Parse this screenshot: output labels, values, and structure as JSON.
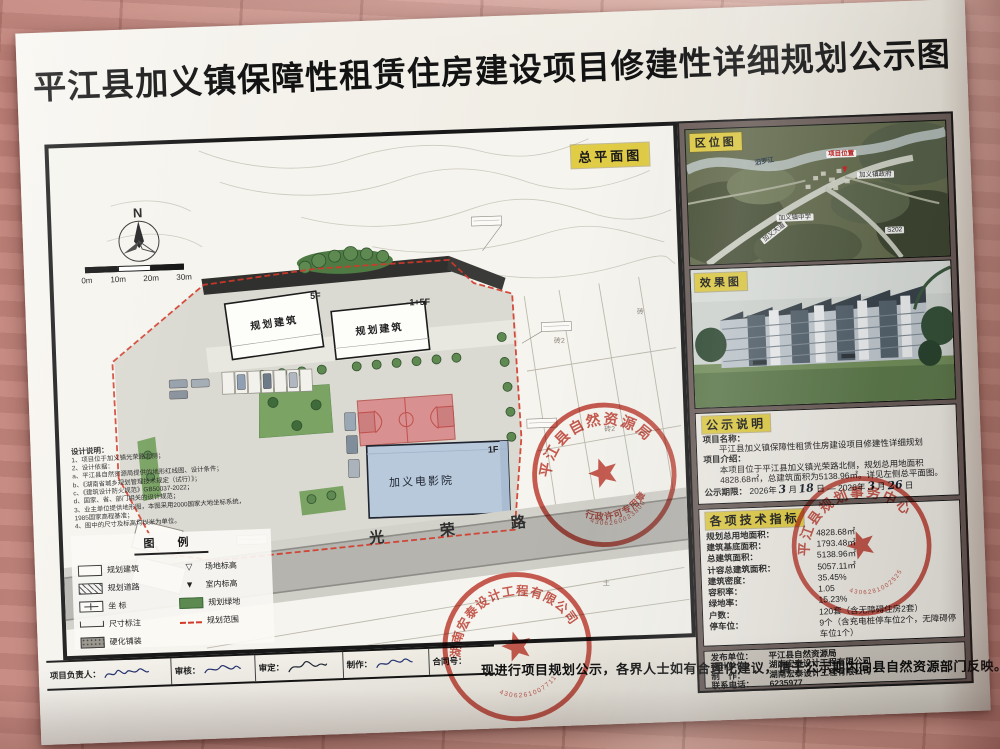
{
  "title": "平江县加义镇保障性租赁住房建设项目修建性详细规划公示图",
  "site_plan": {
    "label": "总平面图",
    "north_label": "N",
    "scale_labels": [
      "0m",
      "10m",
      "20m",
      "30m"
    ],
    "building_left": {
      "name": "规划建筑",
      "floors": "5F"
    },
    "building_right": {
      "name": "规划建筑",
      "floors": "-1+5F"
    },
    "cinema": {
      "name": "加义电影院",
      "floors": "1F"
    },
    "road_name": "光 荣 路",
    "design_notes": {
      "title": "设计说明：",
      "lines": [
        "1、项目位于加义镇光荣路北侧；",
        "2、设计依据：",
        "a、平江县自然资源局提供的地形红线图、设计条件；",
        "b、《湖南省城乡规划管理技术规定（试行）》；",
        "c、《建筑设计防火规范》GB50037-2022；",
        "d、国家、省、部门相关的设计规范；",
        "3、业主单位提供地形图，本图采用2000国家大地坐标系统，1985国家高程基准；",
        "4、图中的尺寸及标高均以米为单位。"
      ]
    },
    "legend": {
      "title": "图 例",
      "left": [
        "规划建筑",
        "规划道路",
        "坐 标",
        "尺寸标注",
        "硬化铺装"
      ],
      "right": [
        "场地标高",
        "室内标高",
        "规划绿地",
        "规划范围"
      ]
    },
    "parcel_labels": [
      "砖2",
      "砖2",
      "砖",
      "土"
    ]
  },
  "location_map": {
    "label": "区位图",
    "project_marker": "项目位置",
    "river": "汨罗江",
    "town_hall": "加义镇政府",
    "school": "加义镇中学",
    "avenue": "加义大道",
    "highway": "S202"
  },
  "rendering": {
    "label": "效果图"
  },
  "notice": {
    "label": "公示说明",
    "name_label": "项目名称：",
    "name": "平江县加义镇保障性租赁住房建设项目修建性详细规划",
    "intro_label": "项目介绍：",
    "intro": "本项目位于平江县加义镇光荣路北侧，规划总用地面积4828.68㎡，总建筑面积为5138.96㎡。详见左侧总平面图。",
    "period_label": "公示期限：",
    "period_parts": [
      "2026年",
      "3",
      "月",
      "18",
      "日 — 2026年",
      "3",
      "月",
      "26",
      "日"
    ]
  },
  "indicators": {
    "label": "各项技术指标",
    "rows": [
      {
        "k": "规划总用地面积：",
        "v": "4828.68㎡"
      },
      {
        "k": "建筑基底面积：",
        "v": "1793.48㎡"
      },
      {
        "k": "总建筑面积：",
        "v": "5138.96㎡"
      },
      {
        "k": "计容总建筑面积：",
        "v": "5057.11㎡"
      },
      {
        "k": "建筑密度：",
        "v": "35.45%"
      },
      {
        "k": "容积率：",
        "v": "1.05"
      },
      {
        "k": "绿地率：",
        "v": "15.23%"
      },
      {
        "k": "户数：",
        "v": "120套（含无障碍住房2套）"
      },
      {
        "k": "停车位：",
        "v": "9个（含充电桩停车位2个，无障碍停车位1个）"
      }
    ]
  },
  "publisher": {
    "rows": [
      {
        "k": "发布单位：",
        "v": "平江县自然资源局"
      },
      {
        "k": "设计单位：",
        "v": "湖南宏泰设计工程有限公司"
      },
      {
        "k": "制　作：",
        "v": "湖南宏泰设计工程有限公司"
      },
      {
        "k": "联系电话：",
        "v": "6235977"
      }
    ]
  },
  "footer": {
    "notice_text": "现进行项目规划公示，各界人士如有合理化建议，请于公示期内向县自然资源部门反映。",
    "fields": [
      "项目负责人：",
      "审核：",
      "审定：",
      "制作：",
      "合同号："
    ]
  },
  "stamps": {
    "bureau": {
      "arc": "平江县自然资源局",
      "sub": "行政许可专用章",
      "serial": "4306260023800"
    },
    "design": {
      "arc": "湖南宏泰设计工程有限公司",
      "serial": "4306261007711"
    },
    "center": {
      "arc": "平江县规划事务中心",
      "serial": "4306281002525"
    }
  },
  "colors": {
    "highlight": "#e0cc45",
    "stamp_red": "#c23a2e",
    "boundary_red": "#d23a2a",
    "sidebar_bg": "#6d5f5b",
    "court_pink": "#d89090",
    "lawn_green": "#7aa364",
    "cinema_blue": "#b9c9dc"
  }
}
